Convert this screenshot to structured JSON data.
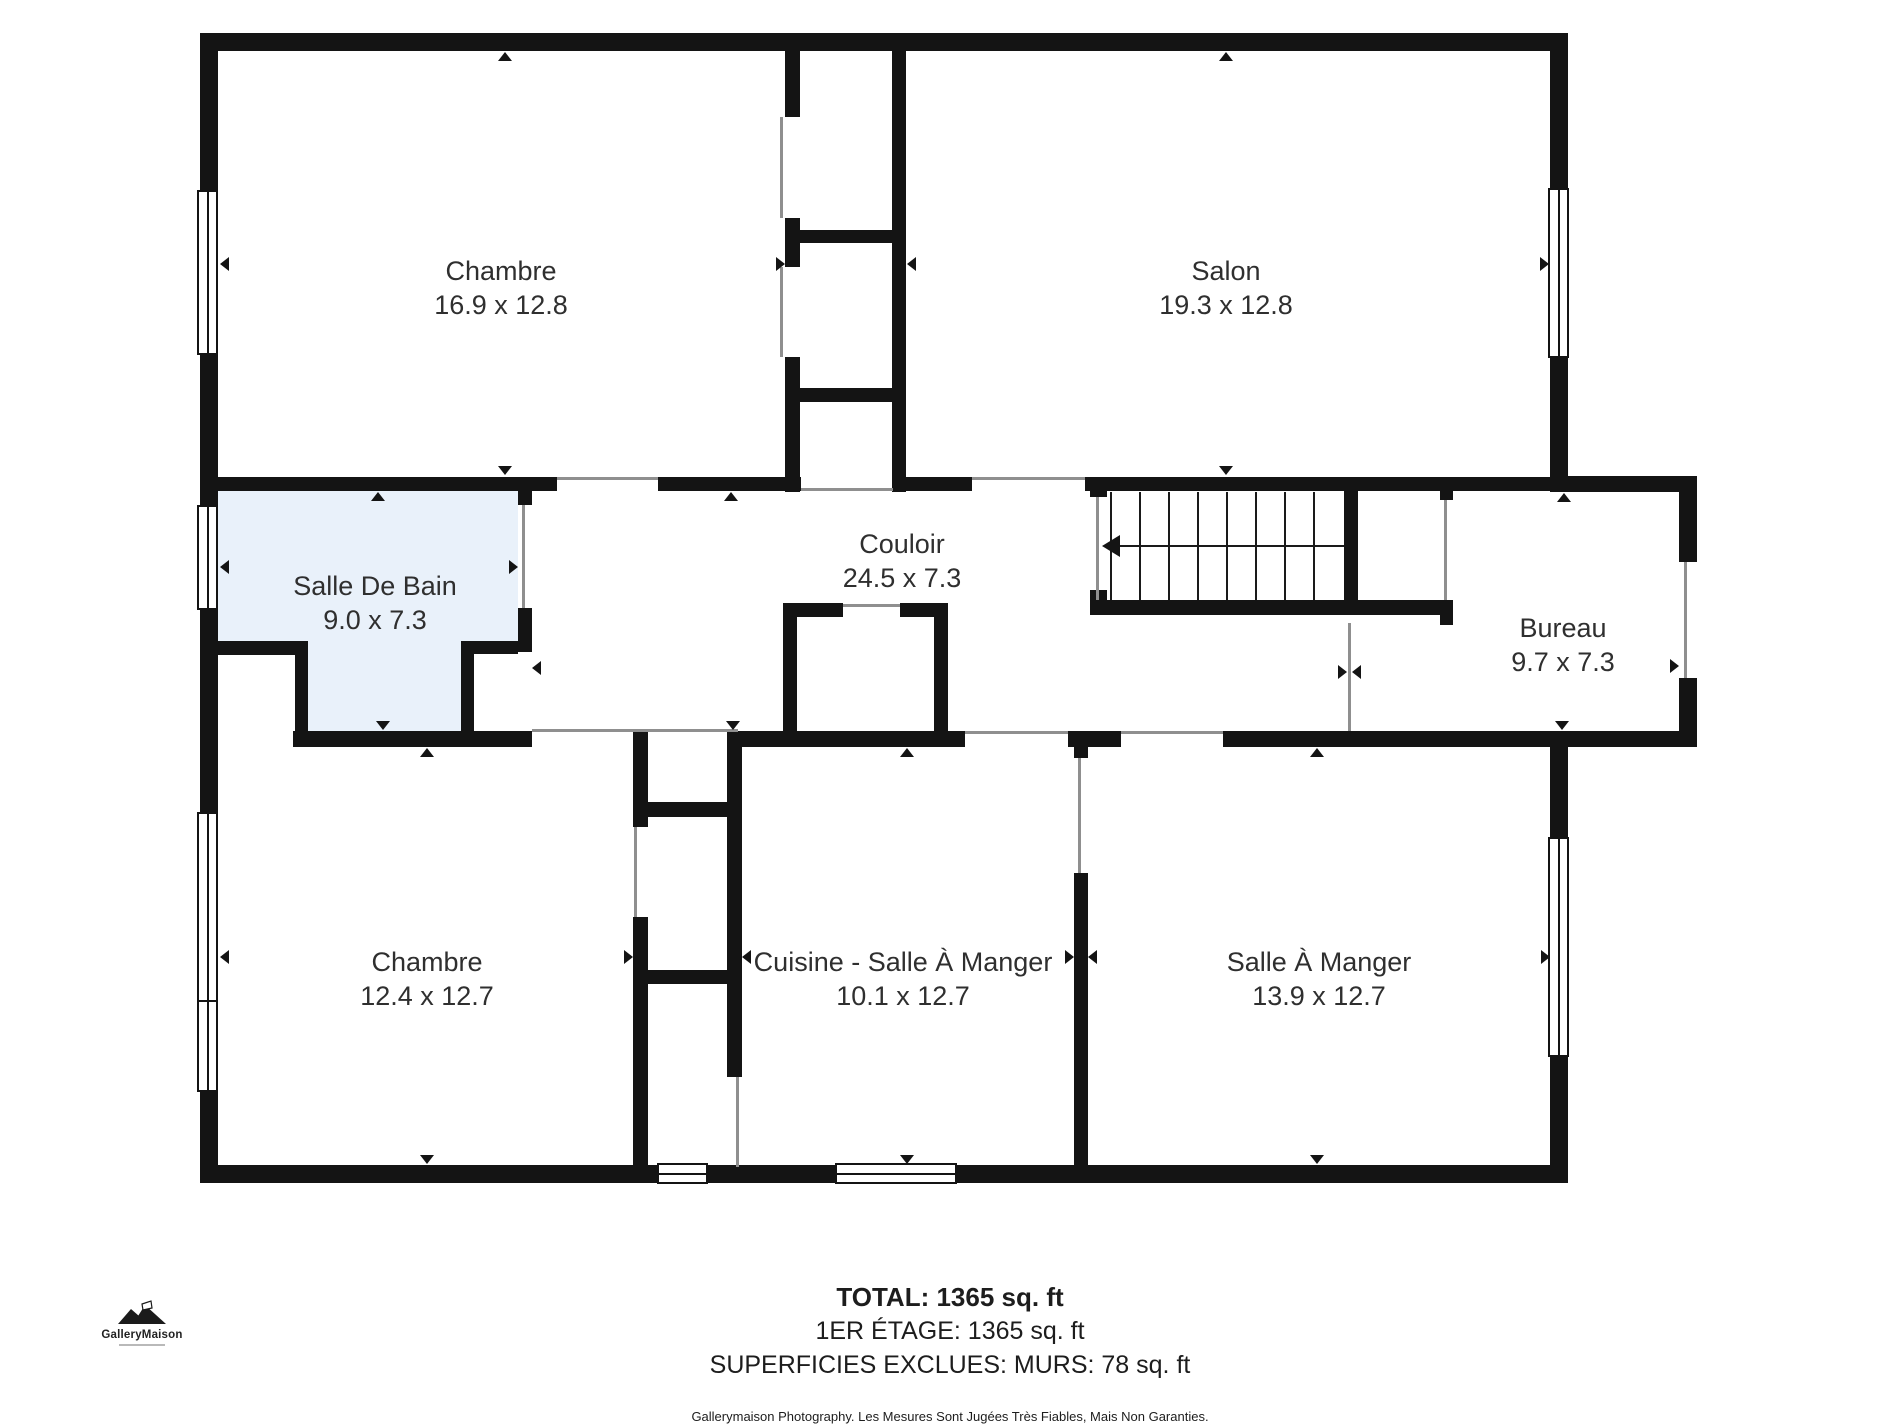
{
  "colors": {
    "wall": "#141414",
    "bathroom_fill": "#e9f1fa",
    "door_line": "#8f8f8f",
    "label_text": "#2f2f2f",
    "footer_text": "#1d1d1d"
  },
  "rooms": [
    {
      "id": "chambre-tl",
      "name": "Chambre",
      "dims": "16.9 x 12.8"
    },
    {
      "id": "salon",
      "name": "Salon",
      "dims": "19.3 x 12.8"
    },
    {
      "id": "salle-de-bain",
      "name": "Salle De Bain",
      "dims": "9.0 x 7.3"
    },
    {
      "id": "couloir",
      "name": "Couloir",
      "dims": "24.5 x 7.3"
    },
    {
      "id": "bureau",
      "name": "Bureau",
      "dims": "9.7 x 7.3"
    },
    {
      "id": "chambre-bl",
      "name": "Chambre",
      "dims": "12.4 x 12.7"
    },
    {
      "id": "cuisine",
      "name": "Cuisine - Salle À Manger",
      "dims": "10.1 x 12.7"
    },
    {
      "id": "salle-a-manger",
      "name": "Salle À Manger",
      "dims": "13.9 x 12.7"
    }
  ],
  "footer": {
    "total": "TOTAL: 1365 sq. ft",
    "floor": "1ER ÉTAGE: 1365 sq. ft",
    "excluded": "SUPERFICIES EXCLUES: MURS: 78 sq. ft",
    "disclaimer": "Gallerymaison Photography. Les Mesures Sont Jugées Très Fiables, Mais Non Garanties."
  },
  "logo": {
    "text": "GalleryMaison"
  },
  "icons": {
    "dimension_marker": "small solid triangle pointing into wall",
    "stairs_direction": "long left arrow across stair treads"
  }
}
